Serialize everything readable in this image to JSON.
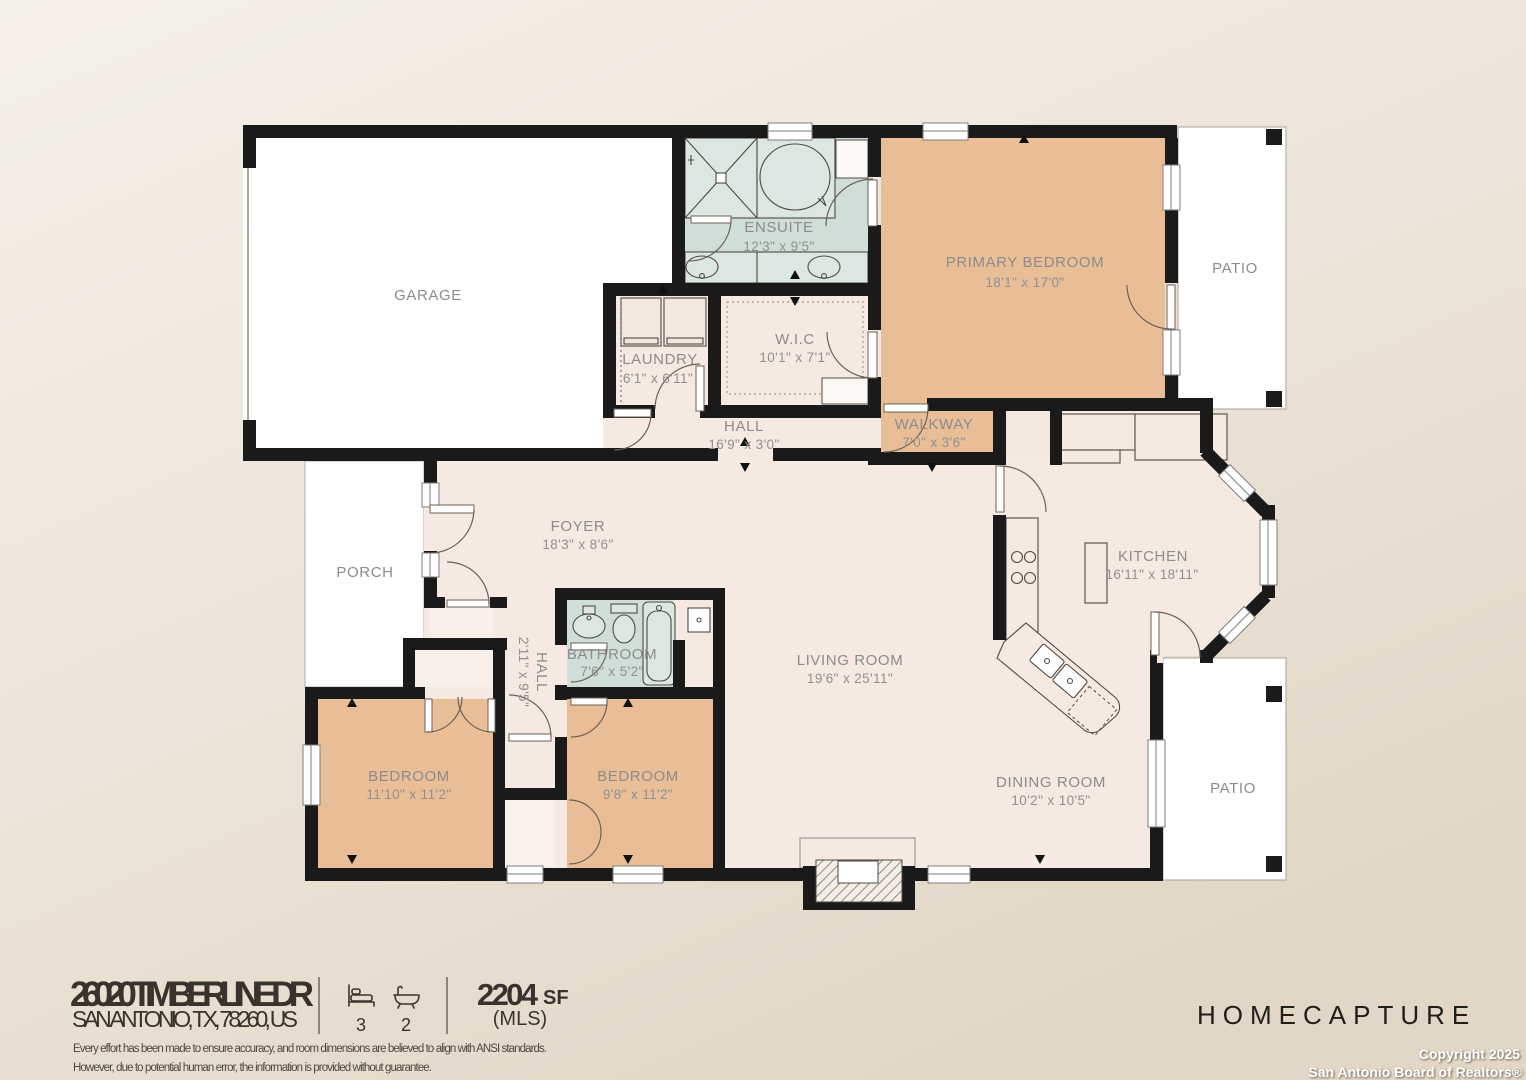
{
  "floorplan": {
    "rooms": [
      {
        "id": "garage",
        "label": "GARAGE",
        "dims": ""
      },
      {
        "id": "ensuite",
        "label": "ENSUITE",
        "dims": "12'3\" x 9'5\""
      },
      {
        "id": "primary-bedroom",
        "label": "PRIMARY BEDROOM",
        "dims": "18'1\" x 17'0\""
      },
      {
        "id": "patio-top",
        "label": "PATIO",
        "dims": ""
      },
      {
        "id": "laundry",
        "label": "LAUNDRY",
        "dims": "6'1\" x 6'11\""
      },
      {
        "id": "wic",
        "label": "W.I.C",
        "dims": "10'1\" x 7'1\""
      },
      {
        "id": "hall",
        "label": "HALL",
        "dims": "16'9\" x 3'0\""
      },
      {
        "id": "walkway",
        "label": "WALKWAY",
        "dims": "7'0\" x 3'6\""
      },
      {
        "id": "foyer",
        "label": "FOYER",
        "dims": "18'3\" x 8'6\""
      },
      {
        "id": "porch",
        "label": "PORCH",
        "dims": ""
      },
      {
        "id": "kitchen",
        "label": "KITCHEN",
        "dims": "16'11\" x 18'11\""
      },
      {
        "id": "hall-2",
        "label": "HALL",
        "dims": "2'11\" x 9'5\""
      },
      {
        "id": "bathroom",
        "label": "BATHROOM",
        "dims": "7'6\" x 5'2\""
      },
      {
        "id": "living-room",
        "label": "LIVING ROOM",
        "dims": "19'6\" x 25'11\""
      },
      {
        "id": "bedroom-left",
        "label": "BEDROOM",
        "dims": "11'10\" x 11'2\""
      },
      {
        "id": "bedroom-middle",
        "label": "BEDROOM",
        "dims": "9'8\" x 11'2\""
      },
      {
        "id": "dining-room",
        "label": "DINING ROOM",
        "dims": "10'2\" x 10'5\""
      },
      {
        "id": "patio-bottom",
        "label": "PATIO",
        "dims": ""
      }
    ],
    "colors": {
      "wall": "#1a1a1a",
      "floor": "#f6e9e1",
      "bedroom_fill": "#e9be97",
      "bath_fill": "#cfded7",
      "outdoor_fill": "#ffffff"
    }
  },
  "footer": {
    "address_line1": "26020 TIMBERLINE DR",
    "address_line2": "SAN ANTONIO, TX, 78260, US",
    "beds": "3",
    "baths": "2",
    "area_value": "2204",
    "area_unit": "SF",
    "area_source": "(MLS)",
    "disclaimer_line1": "Every effort has been made to ensure accuracy, and room dimensions are believed to align with ANSI standards.",
    "disclaimer_line2": "However, due to potential human error, the information is provided without guarantee.",
    "brand": "HOMECAPTURE",
    "copyright_line1": "Copyright 2025",
    "copyright_line2": "San Antonio Board of Realtors®"
  }
}
